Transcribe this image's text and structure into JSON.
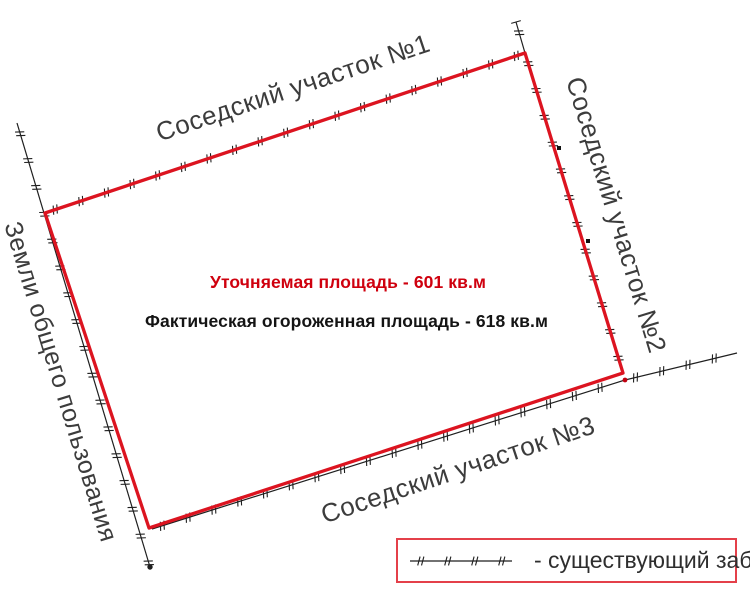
{
  "title": "Схема земельного участка",
  "colors": {
    "boundary": "#dc1420",
    "fence": "#1f1f1f",
    "label": "#3c3c3c",
    "area_refined": "#cf000e",
    "area_actual": "#141414",
    "legend_border": "#e4404a",
    "point_black": "#111111",
    "point_red": "#c00010"
  },
  "drawing": {
    "parcel_polygon": [
      [
        45,
        213
      ],
      [
        525,
        53
      ],
      [
        623,
        373
      ],
      [
        149,
        528
      ]
    ],
    "boundary_width": 3.3,
    "fences": [
      {
        "name": "fence-top",
        "points": [
          [
            45,
            213
          ],
          [
            525,
            53
          ]
        ],
        "spacing": 27,
        "start_tick": false,
        "end_dot": false
      },
      {
        "name": "fence-right",
        "points": [
          [
            516,
            22
          ],
          [
            525,
            53
          ],
          [
            623,
            373
          ]
        ],
        "spacing": 28,
        "start_tick": true,
        "end_dot": false
      },
      {
        "name": "fence-left",
        "points": [
          [
            17,
            123
          ],
          [
            150,
            567
          ]
        ],
        "spacing": 28,
        "start_tick": false,
        "end_dot": true
      },
      {
        "name": "fence-bottom",
        "points": [
          [
            152,
            529
          ],
          [
            625,
            380
          ],
          [
            737,
            353
          ]
        ],
        "spacing": 27,
        "start_tick": false,
        "end_dot": false
      }
    ],
    "survey_points": [
      {
        "x": 559,
        "y": 148,
        "shape": "square",
        "color": "#111111"
      },
      {
        "x": 588,
        "y": 241,
        "shape": "square",
        "color": "#111111"
      },
      {
        "x": 625,
        "y": 380,
        "shape": "circle",
        "color": "#c00010"
      }
    ]
  },
  "labels": {
    "neighbor1": "Соседский участок  №1",
    "neighbor2": "Соседский участок №2",
    "neighbor3": "Соседский участок №3",
    "common_lands": "Земли общего пользования"
  },
  "areas": {
    "refined_text": "Уточняемая площадь - 601 кв.м",
    "actual_text": "Фактическая огороженная площадь  - 618 кв.м"
  },
  "legend": {
    "label": "- существующий забор",
    "symbol": {
      "points": [
        [
          2,
          9
        ],
        [
          104,
          9
        ]
      ],
      "spacing": 27
    }
  }
}
